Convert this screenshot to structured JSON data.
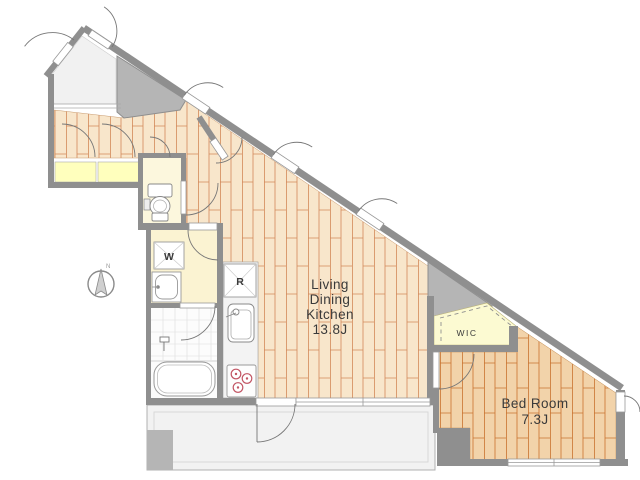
{
  "floorplan": {
    "rooms": {
      "living_dining_kitchen": {
        "name_lines": [
          "Living",
          "Dining",
          "Kitchen"
        ],
        "area": "13.8J"
      },
      "bedroom": {
        "name": "Bed Room",
        "area": "7.3J"
      },
      "wic": {
        "name": "WIC"
      }
    },
    "appliances": {
      "washing_machine": "W",
      "refrigerator": "R"
    },
    "compass": {
      "north": "N"
    },
    "colors": {
      "wood_light": "#f8e6cb",
      "wood_dark": "#f2d3aa",
      "plank_light": "#d3895a",
      "plank_dark": "#c9732f",
      "wall": "#8f8f8f",
      "void": "#b5b5b5",
      "closet_yellow": "#ffffbd",
      "cream": "#fbf3d2",
      "toilet_cream": "#fcf7dd",
      "wic_yellow": "#fcfad2",
      "balcony": "#f2f2f2",
      "entrance": "#f1f1f1",
      "kitchen_counter": "#f3f3f3",
      "burner": "#c25564",
      "text": "#3a3a3a"
    }
  }
}
